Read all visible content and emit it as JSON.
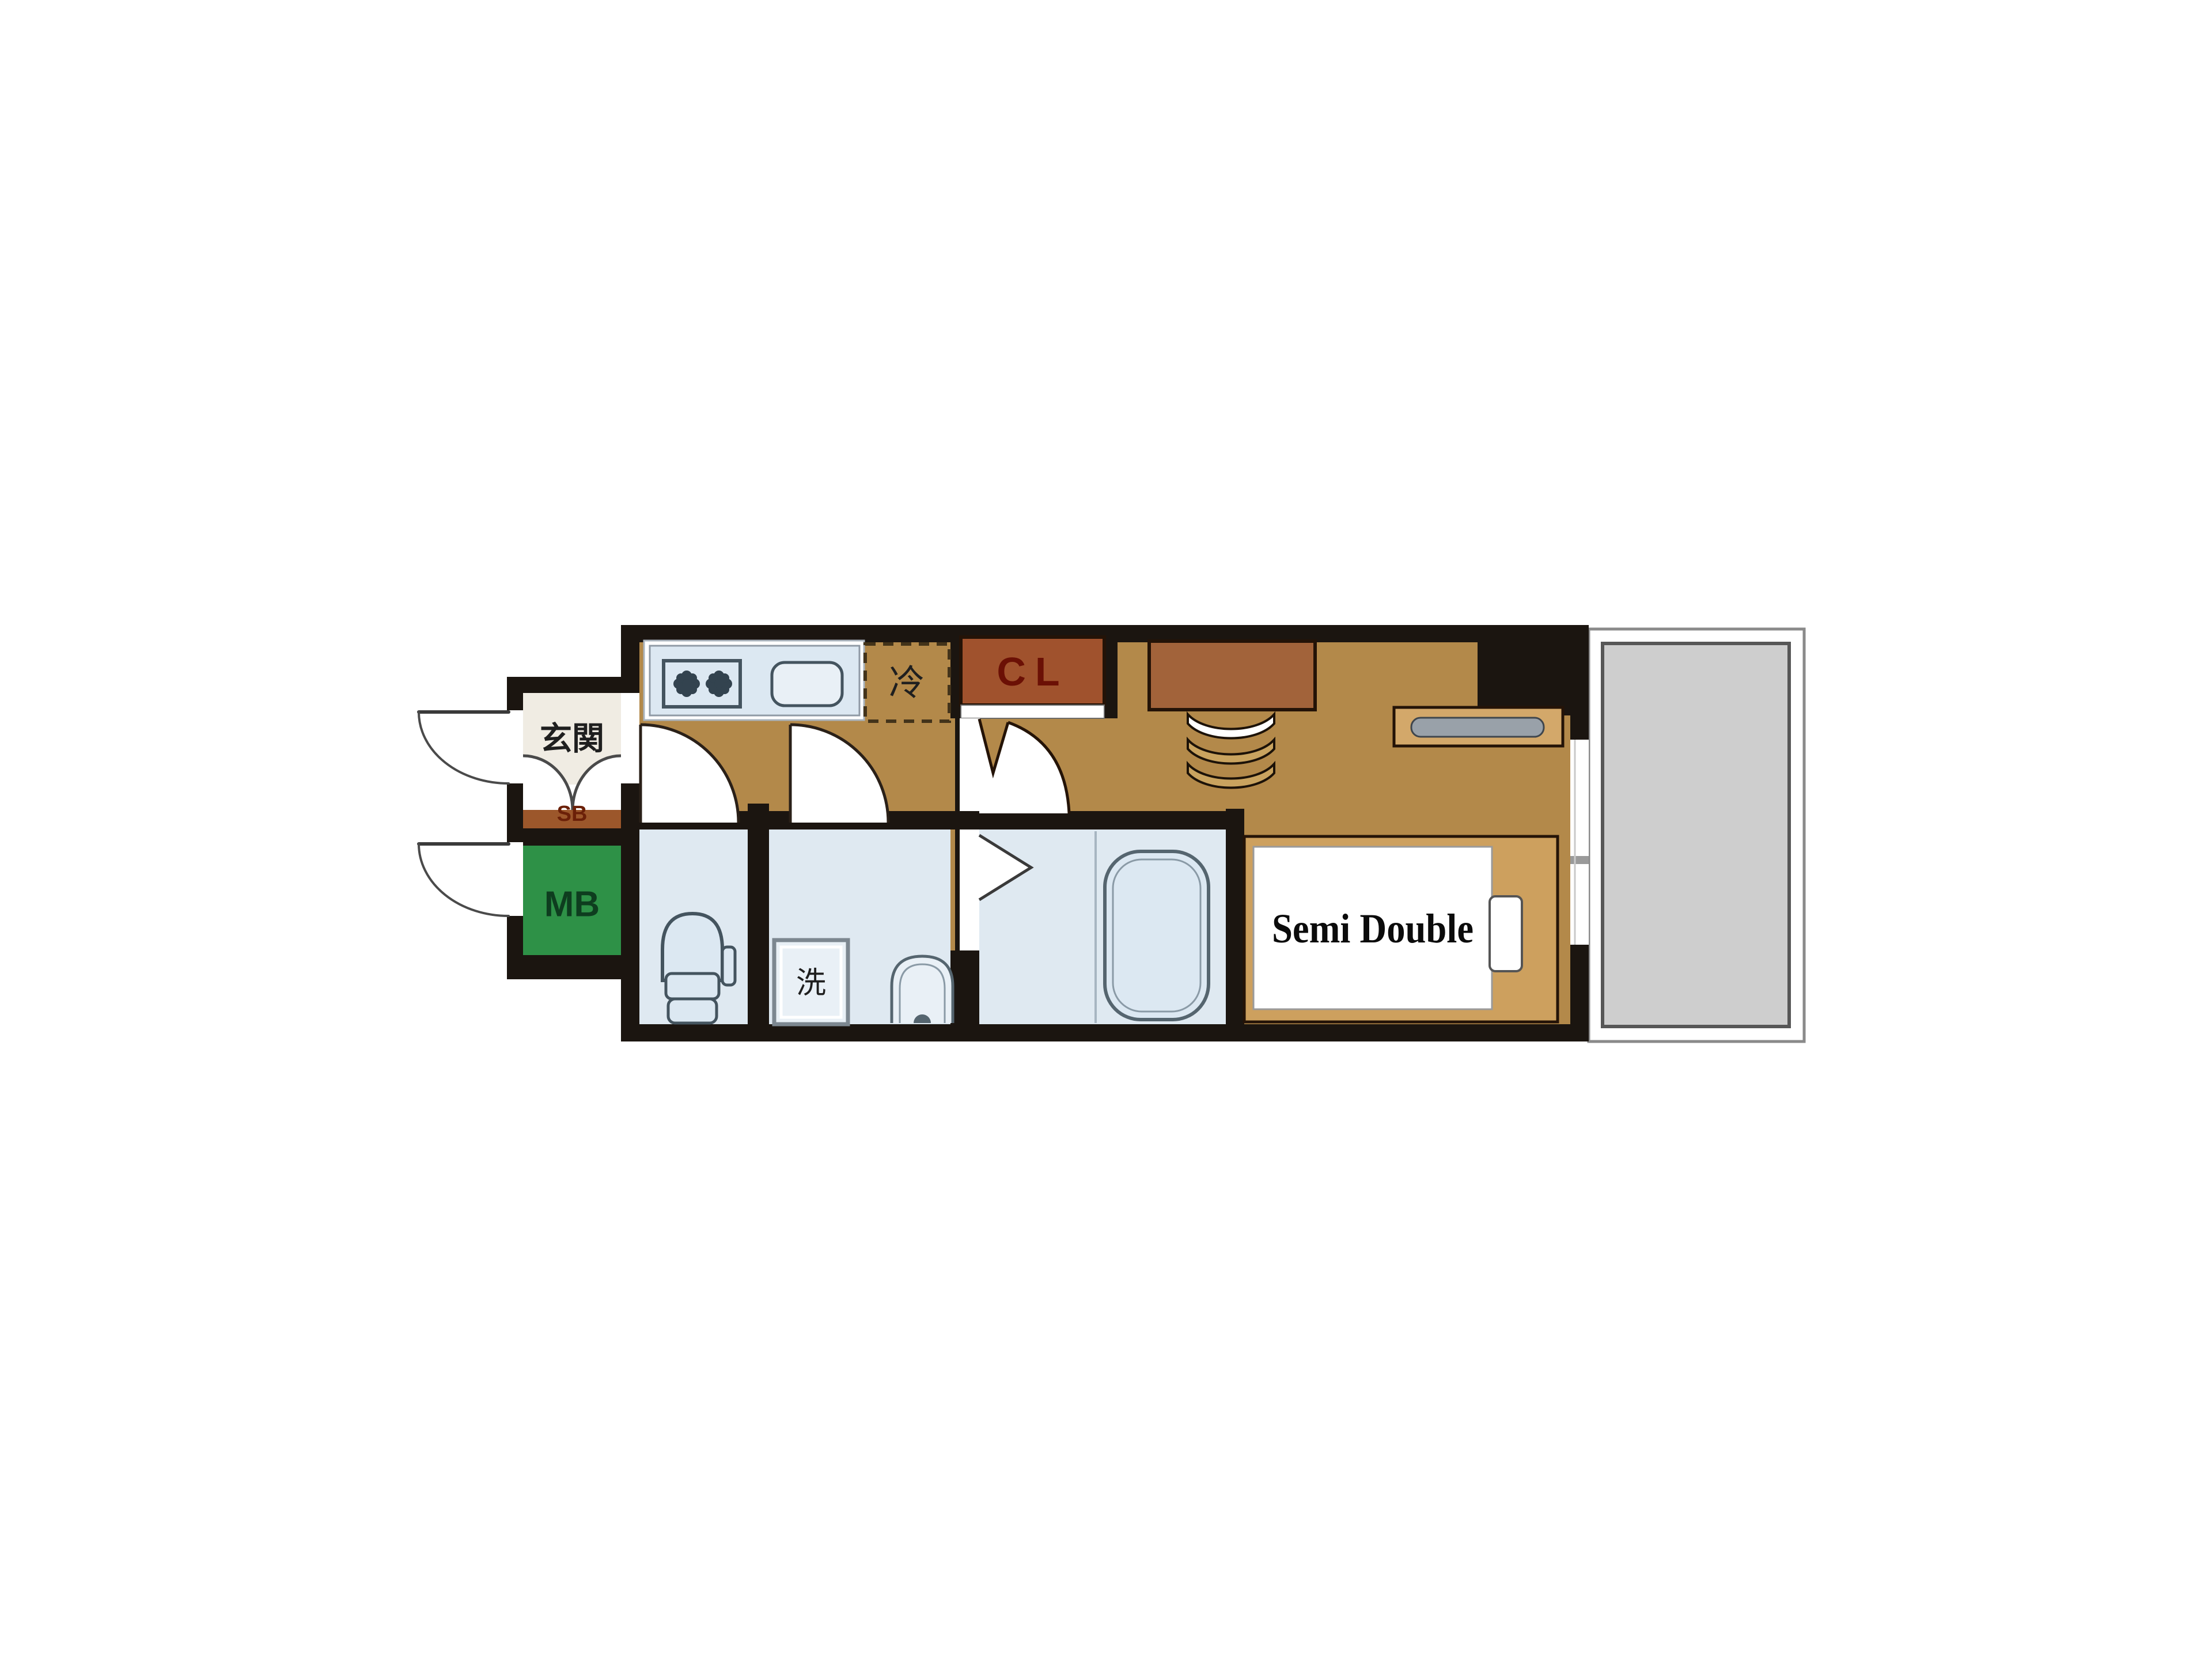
{
  "plan": {
    "type": "apartment-floor-plan",
    "labels": {
      "entrance": "玄関",
      "shoe_box": "SB",
      "meter_box": "MB",
      "closet": "CL",
      "refrigerator": "冷",
      "washer": "洗",
      "bed": "Semi Double"
    },
    "colors": {
      "wall": "#1b1510",
      "wood_floor": "#b3894a",
      "wet_floor": "#dfe9f1",
      "entrance_floor": "#f0ece3",
      "shoe_box": "#9c572b",
      "shoe_box_text": "#6b2008",
      "meter_box": "#2e9147",
      "meter_box_text": "#0e3d1f",
      "closet": "#a0522d",
      "closet_text": "#6b1005",
      "desk": "#a2633a",
      "chair": "#c9a35f",
      "counter": "#d3a86a",
      "counter_handle": "#99a1a9",
      "bed_frame": "#cda05e",
      "bed_mattress": "#ffffff",
      "balcony_deck": "#cecece",
      "fixture_fill": "#dce8f2",
      "fixture_fill_light": "#e9f0f6",
      "fixture_stroke": "#44545f",
      "text_dark": "#1f1f1f",
      "door_stroke": "#2a2018"
    }
  }
}
